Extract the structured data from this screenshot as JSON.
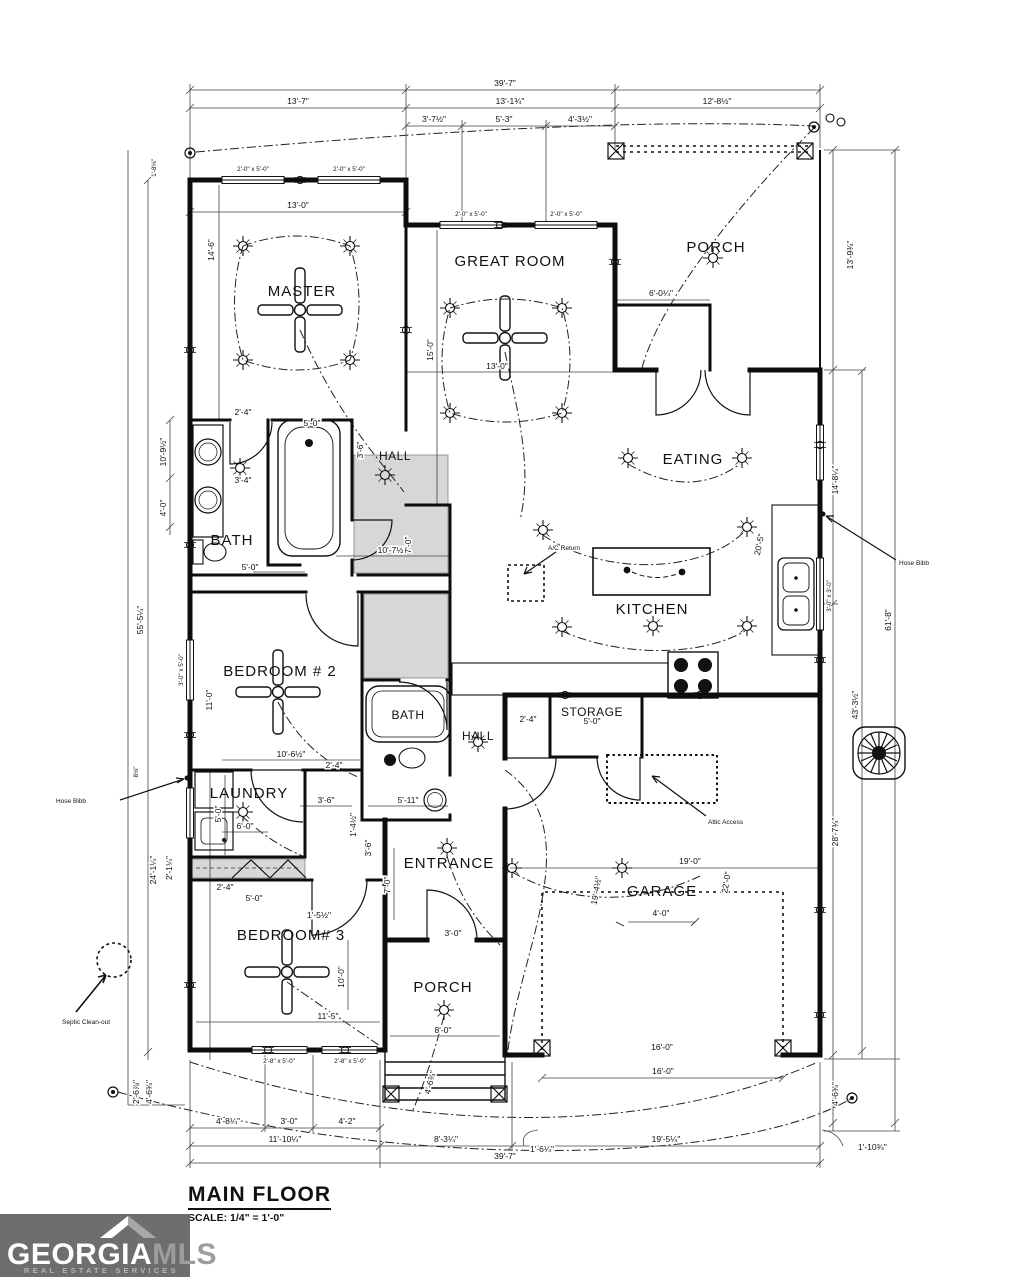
{
  "header": {
    "title": "MAIN FLOOR",
    "scale": "SCALE: 1/4\" = 1'-0\""
  },
  "logo": {
    "brand_primary": "GEORGIA",
    "brand_secondary": "MLS",
    "tagline": "REAL ESTATE SERVICES"
  },
  "rooms": {
    "master": "MASTER",
    "great_room": "GREAT ROOM",
    "porch_top": "PORCH",
    "eating": "EATING",
    "kitchen": "KITCHEN",
    "bath_master": "BATH",
    "hall_upper": "HALL",
    "bedroom2": "BEDROOM # 2",
    "bath2": "BATH",
    "hall_lower": "HALL",
    "storage": "STORAGE",
    "laundry": "LAUNDRY",
    "entrance": "ENTRANCE",
    "bedroom3": "BEDROOM# 3",
    "porch_bottom": "PORCH",
    "garage": "GARAGE"
  },
  "annotations": {
    "ac_return": "A/C Return",
    "attic_access": "Attic Access",
    "hose_bibb_left": "Hose Bibb",
    "hose_bibb_right": "Hose Bibb",
    "septic": "Septic Clean-out"
  },
  "dims": {
    "top_total": "39'-7\"",
    "top_seg1": "13'-7\"",
    "top_seg2": "13'-1¾\"",
    "top_seg3": "12'-8½\"",
    "top_sub1": "3'-7½\"",
    "top_sub2": "5'-3\"",
    "top_sub3": "4'-3½\"",
    "win_master_1": "2'-0\" x 5'-0\"",
    "win_master_2": "2'-0\" x 5'-0\"",
    "win_great_1": "2'-0\" x 5'-0\"",
    "win_great_2": "2'-0\" x 5'-0\"",
    "win_bed2": "3'-0\" x 5'-0\"",
    "win_bed3_1": "2'-8\" x 5'-0\"",
    "win_bed3_2": "2'-8\" x 5'-0\"",
    "win_kitchen": "3'-0\" x 3'-0\"",
    "master_w": "13'-0\"",
    "master_h": "14'-6\"",
    "great_h": "15'-0\"",
    "great_w": "13'-0\"",
    "porch_h": "13'-9¾\"",
    "porch_jog": "6'-0¼\"",
    "eating_h": "14'-8¼\"",
    "kitchen_d": "20'-5\"",
    "right_seg3": "28'-7¾\"",
    "right_seg4": "4'-6¾\"",
    "right_total2": "43'-3½\"",
    "right_total": "61'-8\"",
    "right_corner": "1'-10¾\"",
    "left_total": "55'-5¼\"",
    "left_corner_top": "1'-8⅛\"",
    "left_bath1": "10'-9½\"",
    "left_bath2": "4'-0\"",
    "left_laundry_win": "5'-0\"",
    "left_seg": "24'-1¼\"",
    "left_seg2": "2'-1¼\"",
    "left_bibb": "8⅛\"",
    "left_bottom": "4'-6¾\"",
    "left_bottom2": "2'-6⅞\"",
    "bath_counter": "3'-4\"",
    "bath_w": "5'-0\"",
    "tub_l": "5'-0\"",
    "tub_off": "2'-4\"",
    "hall_w": "10'-7½\"",
    "hall_d": "7'-0\"",
    "hall_cl": "3'-6\"",
    "bed2_w": "10'-6½\"",
    "bed2_h": "11'-0\"",
    "bath2_off": "2'-4\"",
    "bath2_w1": "3'-6\"",
    "bath2_w2": "5'-11\"",
    "bath2_h": "1'-4½\"",
    "laundry_w": "6'-0\"",
    "storage_w": "5'-0\"",
    "storage_off": "2'-4\"",
    "ent_h1": "3'-6\"",
    "ent_h2": "7'-0\"",
    "ent_door": "3'-0\"",
    "porchb_w": "8'-0\"",
    "porchb_d": "4'-6¾\"",
    "bed3_off": "2'-4\"",
    "bed3_d1": "5'-0\"",
    "bed3_d2": "1'-5½\"",
    "bed3_h": "10'-0\"",
    "bed3_w": "11'-5\"",
    "gar_w": "19'-0\"",
    "gar_h1": "19'-4½\"",
    "gar_h2": "22'-0\"",
    "gar_clear": "4'-0\"",
    "gar_door": "16'-0\"",
    "bot_sub1": "4'-8¼\"",
    "bot_sub2": "3'-0\"",
    "bot_sub3": "4'-2\"",
    "bot_seg1": "11'-10¼\"",
    "bot_seg2": "8'-3¼\"",
    "bot_off1": "1'-6¼\"",
    "bot_seg3": "19'-5¼\"",
    "bot_off2": "1'-10¾\"",
    "bot_total": "39'-7\""
  }
}
